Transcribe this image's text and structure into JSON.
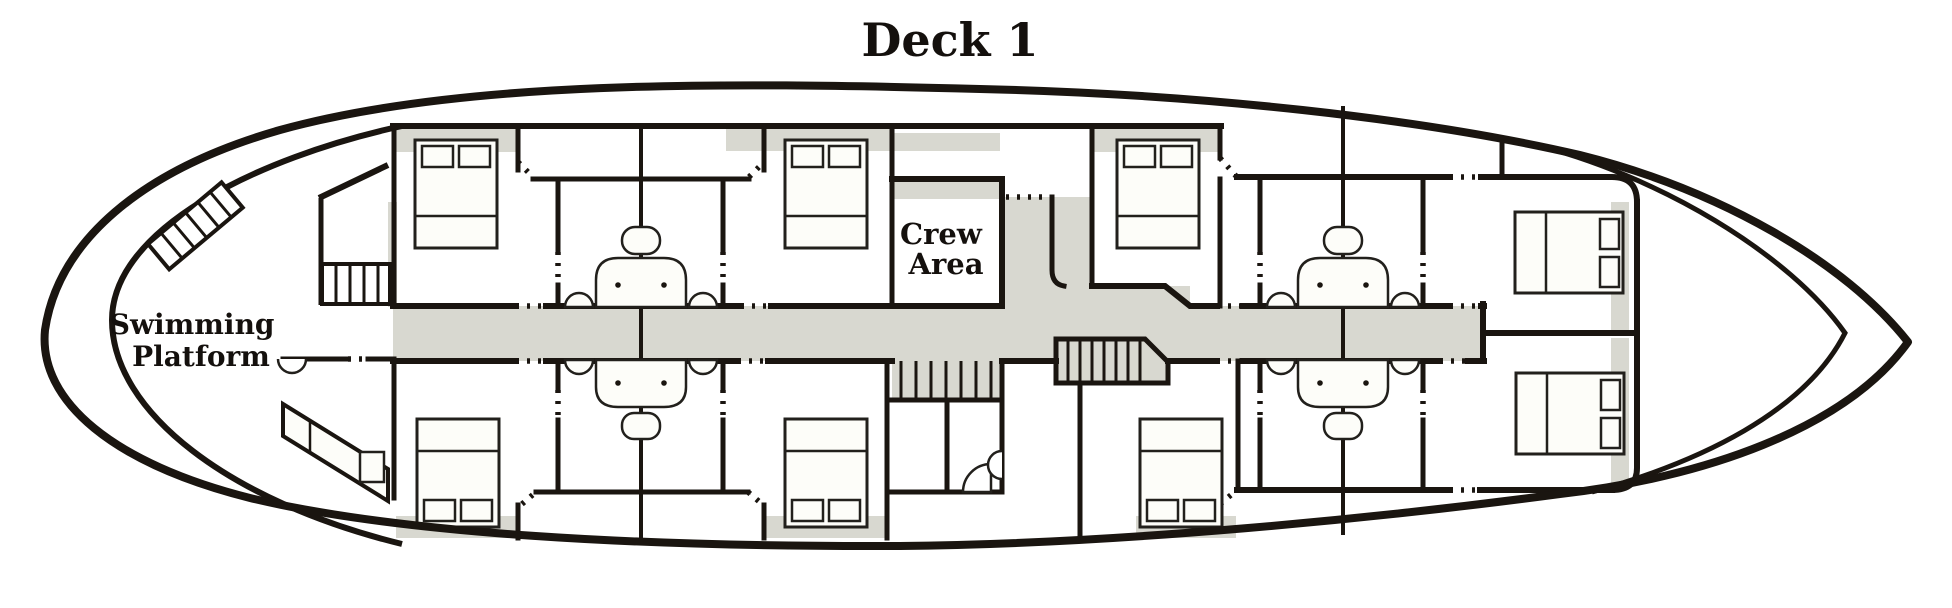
{
  "title": "Deck 1",
  "labels": {
    "swimming_platform": {
      "line1": "Swimming",
      "line2": "Platform"
    },
    "crew_area": {
      "line1": "Crew",
      "line2": "Area"
    }
  },
  "colors": {
    "ink": "#1a1510",
    "corridor_gray": "#d8d8d0",
    "furniture_fill": "#fdfdf9",
    "background": "#ffffff"
  }
}
